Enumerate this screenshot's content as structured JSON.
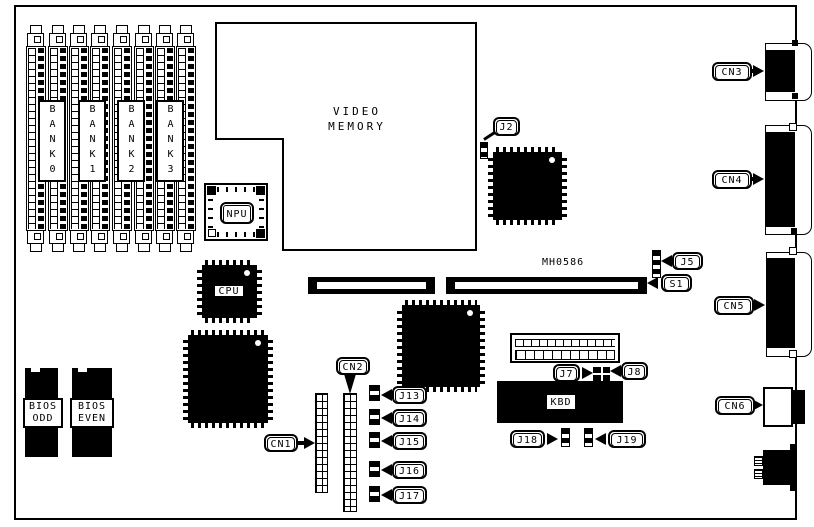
{
  "colors": {
    "ink": "#000000",
    "paper": "#ffffff"
  },
  "memory_banks": {
    "labels": [
      "BANK0",
      "BANK1",
      "BANK2",
      "BANK3"
    ]
  },
  "chips": {
    "video_memory": {
      "line1": "VIDEO",
      "line2": "MEMORY"
    },
    "npu": "NPU",
    "cpu": "CPU",
    "kbd": "KBD",
    "bios_odd": {
      "line1": "BIOS",
      "line2": "ODD"
    },
    "bios_even": {
      "line1": "BIOS",
      "line2": "EVEN"
    }
  },
  "text_labels": {
    "board_id": "MH0586"
  },
  "callouts": {
    "j2": "J2",
    "j5": "J5",
    "s1": "S1",
    "j7": "J7",
    "j8": "J8",
    "j13": "J13",
    "j14": "J14",
    "j15": "J15",
    "j16": "J16",
    "j17": "J17",
    "j18": "J18",
    "j19": "J19",
    "cn1": "CN1",
    "cn2": "CN2",
    "cn3": "CN3",
    "cn4": "CN4",
    "cn5": "CN5",
    "cn6": "CN6"
  }
}
